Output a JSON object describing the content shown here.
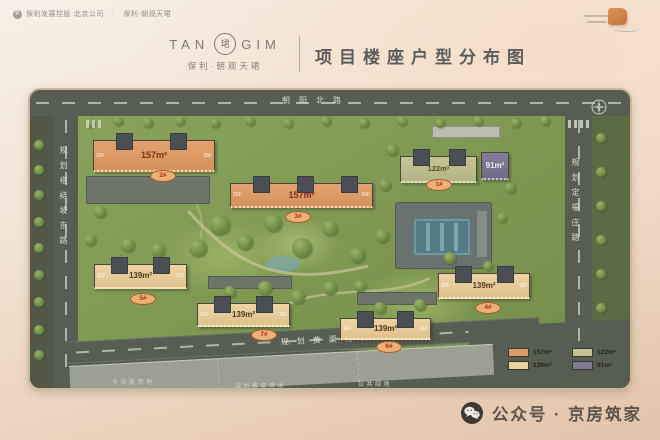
{
  "header": {
    "company_bar": {
      "brand_left": "保利发展控股·北京公司",
      "separator": "｜",
      "brand_right": "保利·朝观天珺"
    },
    "logo": {
      "word_left": "TAN",
      "word_right": "GIM",
      "seal_char": "珺",
      "subtitle": "保利·朝观天珺"
    },
    "page_title": "项目楼座户型分布图"
  },
  "map": {
    "roads": {
      "north": "朝阳北路",
      "west": "规划褡裢坡东路",
      "east": "规划定福庄路",
      "south": "规划黄渠南街"
    },
    "land_labels": [
      "多功能用地",
      "规划教育用地",
      "公共绿地"
    ],
    "buildings": {
      "b1": {
        "name": "1#",
        "area": "122m²"
      },
      "b91": {
        "area": "91m²"
      },
      "b2": {
        "name": "2#",
        "area": "157m²",
        "floor_left": "26F",
        "floor_right": "25F"
      },
      "b3": {
        "name": "3#",
        "area": "157m²",
        "floor_left": "25F",
        "floor_right": "26F"
      },
      "b4": {
        "name": "4#",
        "area": "139m²",
        "floor_left": "11F",
        "floor_right": "11F"
      },
      "b5": {
        "name": "5#",
        "area": "139m²",
        "floor_left": "11F",
        "floor_right": "11F"
      },
      "b6": {
        "name": "6#",
        "area": "139m²",
        "floor_left": "11F",
        "floor_right": "11F"
      },
      "b7": {
        "name": "7#",
        "area": "139m²",
        "floor_left": "11F",
        "floor_right": "11F"
      }
    },
    "legend": [
      {
        "label": "157m²",
        "color": "#dd9a66"
      },
      {
        "label": "122m²",
        "color": "#c2c294"
      },
      {
        "label": "139m²",
        "color": "#ecd0a0"
      },
      {
        "label": "91m²",
        "color": "#7f7894"
      }
    ]
  },
  "footer": {
    "wechat_label": "公众号 · 京房筑家"
  }
}
